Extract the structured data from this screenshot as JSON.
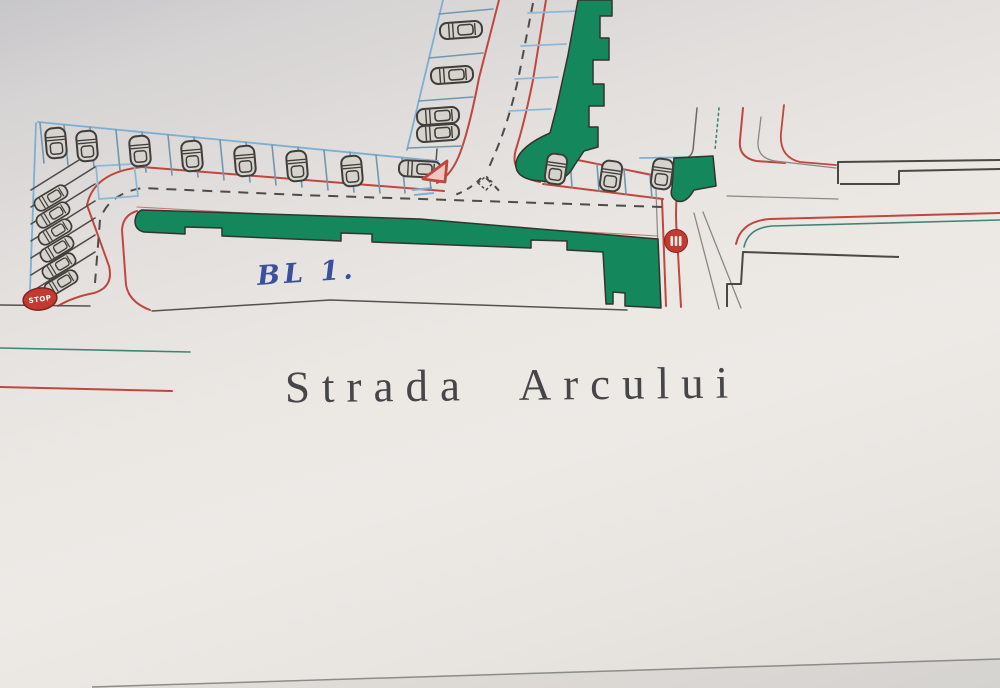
{
  "photo": {
    "description": "Photographed hand-drawn street site plan with parking rows, green buildings and traffic signs"
  },
  "labels": {
    "street_name": "Strada Arcului",
    "building": "BL 1.",
    "stop_sign": "STOP"
  },
  "signs": {
    "stop_ellipse_text": "STOP",
    "disc_sign": "red-disc-traffic-sign",
    "yield_triangle": "red-yield-triangle"
  },
  "colors": {
    "building_green": "#14875d",
    "road_red": "#c0473f",
    "parking_blue": "#7fafd0",
    "divider_blue": "#7297ad",
    "line_teal": "#3f8577",
    "ink_gray": "#55524e",
    "outline_dark": "#4a4843",
    "label_blue": "#3b4f9f",
    "text_gray": "#46464a",
    "sign_red": "#c23b32"
  },
  "parking": {
    "top_row_cars": 8,
    "street_left_cars": 4,
    "diagonal_cars": 6,
    "lower_right_cars": 3
  }
}
